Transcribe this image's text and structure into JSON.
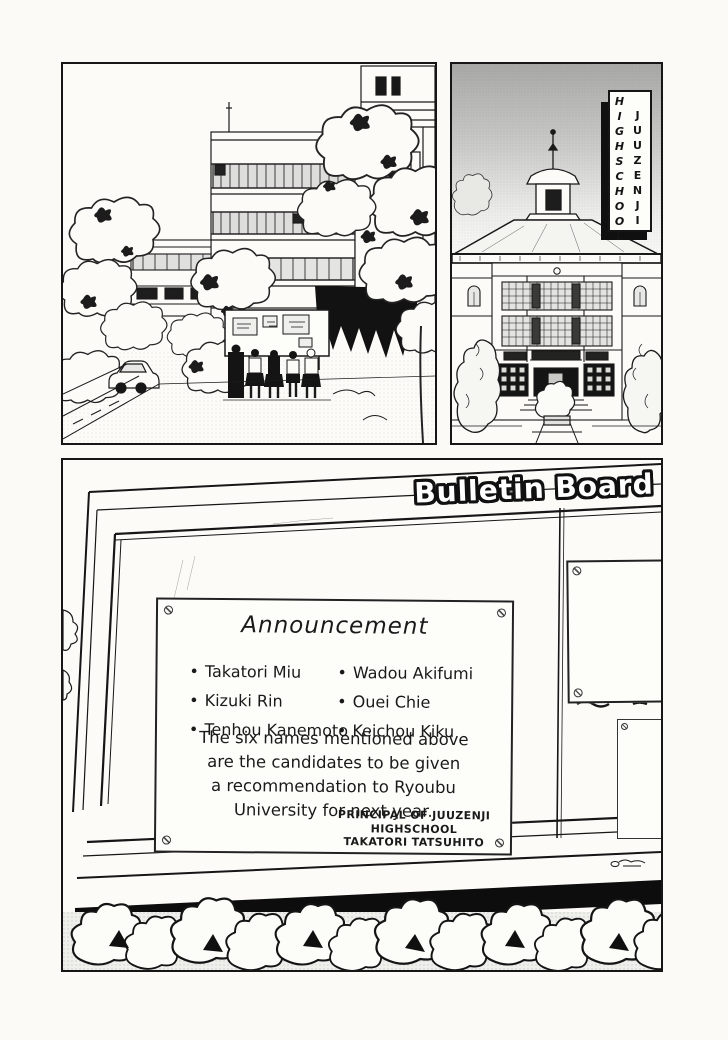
{
  "sign": {
    "column_left": "HIGHSCHOOL",
    "column_right": "JUUZENJI"
  },
  "board": {
    "title": "Bulletin Board",
    "announcement": {
      "heading": "Announcement",
      "bullet": "•",
      "names_left": [
        "Takatori Miu",
        "Kizuki Rin",
        "Tenhou Kanemoto"
      ],
      "names_right": [
        "Wadou Akifumi",
        "Ouei Chie",
        "Keichou Kiku"
      ],
      "body_lines": [
        "The six names mentioned above",
        "are the candidates to be given",
        "a recommendation to Ryoubu",
        "University for next year."
      ],
      "signature_lines": [
        "PRINCIPAL OF JUUZENJI",
        "HIGHSCHOOL",
        "TAKATORI TATSUHITO"
      ]
    },
    "club_poster_heading": "柔術部"
  },
  "colors": {
    "ink": "#1a1a1a",
    "paper": "#fcfbf8",
    "sky_top": "#a8a8a6",
    "shadow": "#0d0d0d"
  }
}
